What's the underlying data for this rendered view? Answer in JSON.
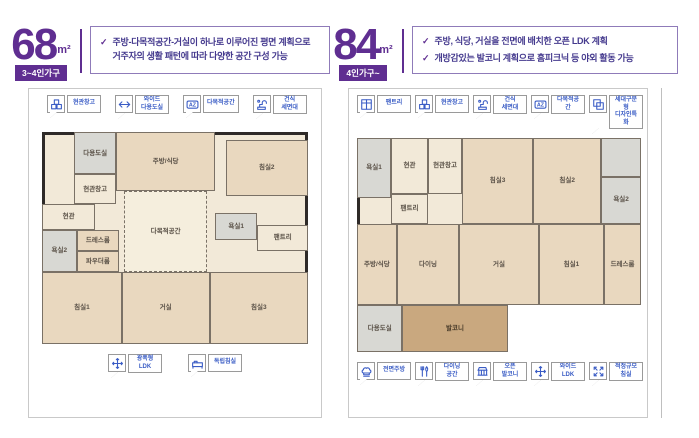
{
  "ui": {
    "check_glyph": "✓"
  },
  "colors": {
    "purple": "#5f2e91",
    "text_indigo": "#453a8e",
    "legend_blue": "#3a5cc5",
    "wall": "#2e2a28",
    "floor_beige": "#e9d8bf"
  },
  "left_plan": {
    "area_value": "68",
    "area_unit": "m²",
    "household_badge": "3~4인가구",
    "bullets": [
      "주방-다목적공간-거실이 하나로 이루어진 평면 계획으로 거주자의 생활 패턴에 따라 다양한 공간 구성 가능"
    ],
    "legend_top": [
      {
        "icon": "storage-boxes-icon",
        "label": "현관창고"
      },
      {
        "icon": "wide-arrow-icon",
        "label": "와이드\n다용도실"
      },
      {
        "icon": "az-badge-icon",
        "label": "다목적공간"
      },
      {
        "icon": "faucet-icon",
        "label": "건식\n세면대"
      }
    ],
    "legend_bottom": [
      {
        "icon": "move-arrows-icon",
        "label": "광폭형\nLDK"
      },
      {
        "icon": "bed-icon",
        "label": "독립침실"
      }
    ],
    "rooms": [
      {
        "label": "다용도실",
        "x": 12,
        "y": 0,
        "w": 16,
        "h": 20,
        "t": "wet"
      },
      {
        "label": "주방/식당",
        "x": 28,
        "y": 0,
        "w": 37,
        "h": 28,
        "t": "floor"
      },
      {
        "label": "침실2",
        "x": 69,
        "y": 4,
        "w": 31,
        "h": 26,
        "t": "floor"
      },
      {
        "label": "현관창고",
        "x": 12,
        "y": 20,
        "w": 16,
        "h": 14,
        "t": "hall"
      },
      {
        "label": "현관",
        "x": 0,
        "y": 34,
        "w": 20,
        "h": 12,
        "t": "hall"
      },
      {
        "label": "욕실2",
        "x": 0,
        "y": 46,
        "w": 13,
        "h": 20,
        "t": "wet"
      },
      {
        "label": "드레스룸",
        "x": 13,
        "y": 46,
        "w": 16,
        "h": 10,
        "t": "floor"
      },
      {
        "label": "파우더룸",
        "x": 13,
        "y": 56,
        "w": 16,
        "h": 10,
        "t": "floor"
      },
      {
        "label": "다목적공간",
        "x": 31,
        "y": 28,
        "w": 31,
        "h": 38,
        "t": "flex"
      },
      {
        "label": "욕실1",
        "x": 65,
        "y": 38,
        "w": 16,
        "h": 13,
        "t": "wet"
      },
      {
        "label": "팬트리",
        "x": 81,
        "y": 44,
        "w": 19,
        "h": 12,
        "t": "hall"
      },
      {
        "label": "침실1",
        "x": 0,
        "y": 66,
        "w": 30,
        "h": 34,
        "t": "floor"
      },
      {
        "label": "거실",
        "x": 30,
        "y": 66,
        "w": 33,
        "h": 34,
        "t": "floor"
      },
      {
        "label": "침실3",
        "x": 63,
        "y": 66,
        "w": 37,
        "h": 34,
        "t": "floor"
      }
    ]
  },
  "right_plan": {
    "area_value": "84",
    "area_unit": "m²",
    "household_badge": "4인가구~",
    "bullets": [
      "주방, 식당, 거실을 전면에 배치한 오픈 LDK 계획",
      "개방감있는 발코니 계획으로 홈피크닉 등 야외 활동 가능"
    ],
    "legend_top": [
      {
        "icon": "pantry-icon",
        "label": "팬트리"
      },
      {
        "icon": "storage-boxes-icon",
        "label": "현관창고"
      },
      {
        "icon": "faucet-icon",
        "label": "건식\n세면대"
      },
      {
        "icon": "az-badge-icon",
        "label": "다목적공간"
      },
      {
        "icon": "dual-unit-icon",
        "label": "세대구분형\n디자인특화"
      }
    ],
    "legend_bottom": [
      {
        "icon": "chef-hat-icon",
        "label": "전면주방"
      },
      {
        "icon": "cutlery-icon",
        "label": "다이닝\n공간"
      },
      {
        "icon": "balcony-icon",
        "label": "오픈\n발코니"
      },
      {
        "icon": "move-arrows-icon",
        "label": "와이드\nLDK"
      },
      {
        "icon": "diagonal-arrows-icon",
        "label": "적정규모\n침실"
      }
    ],
    "rooms": [
      {
        "label": "욕실1",
        "x": 0,
        "y": 0,
        "w": 12,
        "h": 28,
        "t": "wet"
      },
      {
        "label": "현관",
        "x": 12,
        "y": 0,
        "w": 13,
        "h": 26,
        "t": "hall"
      },
      {
        "label": "현관창고",
        "x": 25,
        "y": 0,
        "w": 12,
        "h": 26,
        "t": "hall"
      },
      {
        "label": "침실3",
        "x": 37,
        "y": 0,
        "w": 25,
        "h": 40,
        "t": "floor"
      },
      {
        "label": "침실2",
        "x": 62,
        "y": 0,
        "w": 24,
        "h": 40,
        "t": "floor"
      },
      {
        "label": "",
        "x": 86,
        "y": 0,
        "w": 14,
        "h": 18,
        "t": "wet"
      },
      {
        "label": "욕실2",
        "x": 86,
        "y": 18,
        "w": 14,
        "h": 22,
        "t": "wet"
      },
      {
        "label": "팬트리",
        "x": 12,
        "y": 26,
        "w": 13,
        "h": 14,
        "t": "hall"
      },
      {
        "label": "주방/식당",
        "x": 0,
        "y": 40,
        "w": 14,
        "h": 38,
        "t": "floor"
      },
      {
        "label": "다이닝",
        "x": 14,
        "y": 40,
        "w": 22,
        "h": 38,
        "t": "floor"
      },
      {
        "label": "거실",
        "x": 36,
        "y": 40,
        "w": 28,
        "h": 38,
        "t": "floor"
      },
      {
        "label": "침실1",
        "x": 64,
        "y": 40,
        "w": 23,
        "h": 38,
        "t": "floor"
      },
      {
        "label": "드레스룸",
        "x": 87,
        "y": 40,
        "w": 13,
        "h": 38,
        "t": "floor"
      },
      {
        "label": "다용도실",
        "x": 0,
        "y": 78,
        "w": 16,
        "h": 22,
        "t": "wet"
      },
      {
        "label": "발코니",
        "x": 16,
        "y": 78,
        "w": 37,
        "h": 22,
        "t": "wood"
      }
    ]
  }
}
